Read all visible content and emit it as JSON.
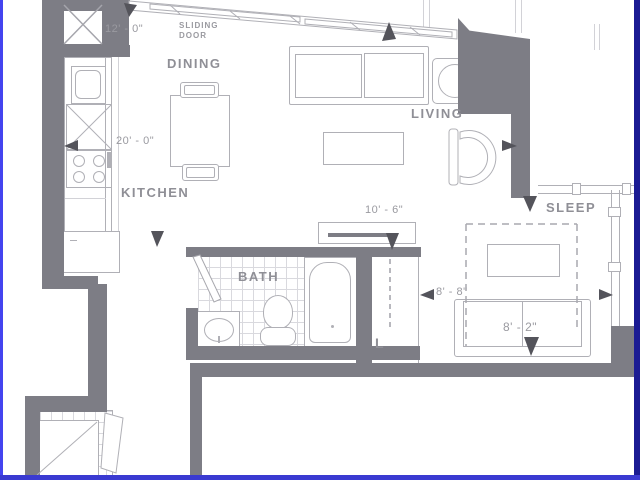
{
  "title": "apartment-floor-plan",
  "rooms": {
    "dining": "DINING",
    "kitchen": "KITCHEN",
    "living": "LIVING",
    "sleep": "SLEEP",
    "bath": "BATH",
    "laundry": "L"
  },
  "annotations": {
    "sliding_door": "SLIDING DOOR"
  },
  "dimensions": {
    "balcony_wall": "12' - 0\"",
    "unit_width": "20' - 0\"",
    "hall_closet": "10' - 6\"",
    "sleep_width": "8' - 8\"",
    "bed_width": "8' - 2\""
  },
  "colors": {
    "wall": "#7d7d85",
    "line": "#b0b0b6",
    "line_light": "#d2d2d7",
    "grid": "#d9d9de",
    "text": "#8f8f96",
    "dim_text": "#9a9aa0",
    "arrow": "#54545b",
    "border_left": "#4444ef",
    "border_right": "#1b1b93",
    "border_bottom": "#3a3ad1",
    "bg": "#ffffff"
  }
}
